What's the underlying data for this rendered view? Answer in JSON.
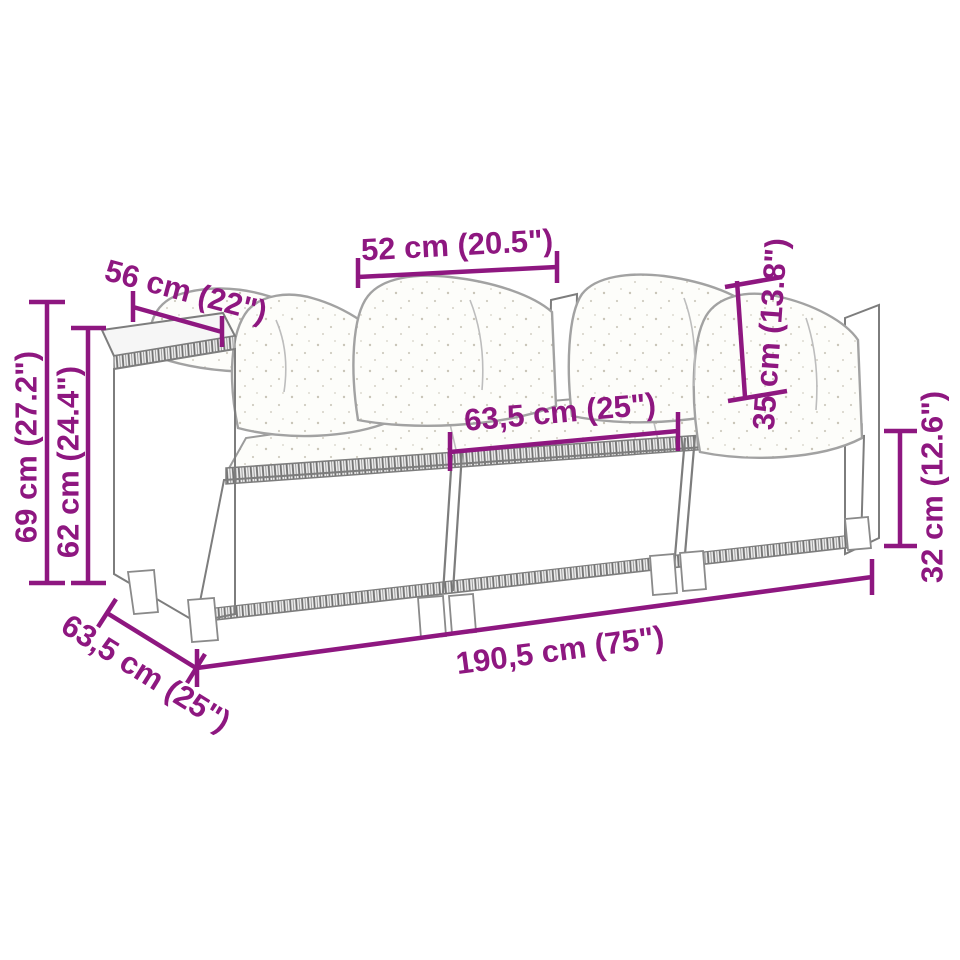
{
  "diagram": {
    "kind": "product-dimension-diagram",
    "subject": "rattan-garden-sofa-3-modules-with-cushions",
    "background_color": "#ffffff",
    "accent_color": "#8e1780",
    "line_art_color": "#7d7d7d"
  },
  "dimensions": {
    "cushion_width": {
      "label": "52 cm (20.5\")",
      "cm": "52",
      "inches": "20.5"
    },
    "arm_depth": {
      "label": "56 cm (22\")",
      "cm": "56",
      "inches": "22"
    },
    "total_height": {
      "label": "69 cm (27.2\")",
      "cm": "69",
      "inches": "27.2"
    },
    "back_height": {
      "label": "62 cm (24.4\")",
      "cm": "62",
      "inches": "24.4"
    },
    "module_width": {
      "label": "63,5 cm (25\")",
      "cm": "63,5",
      "inches": "25"
    },
    "back_cushion_height": {
      "label": "35 cm (13.8\")",
      "cm": "35",
      "inches": "13.8"
    },
    "base_height": {
      "label": "32 cm (12.6\")",
      "cm": "32",
      "inches": "12.6"
    },
    "total_length": {
      "label": "190,5 cm (75\")",
      "cm": "190,5",
      "inches": "75"
    },
    "total_depth": {
      "label": "63,5 cm (25\")",
      "cm": "63,5",
      "inches": "25"
    }
  }
}
